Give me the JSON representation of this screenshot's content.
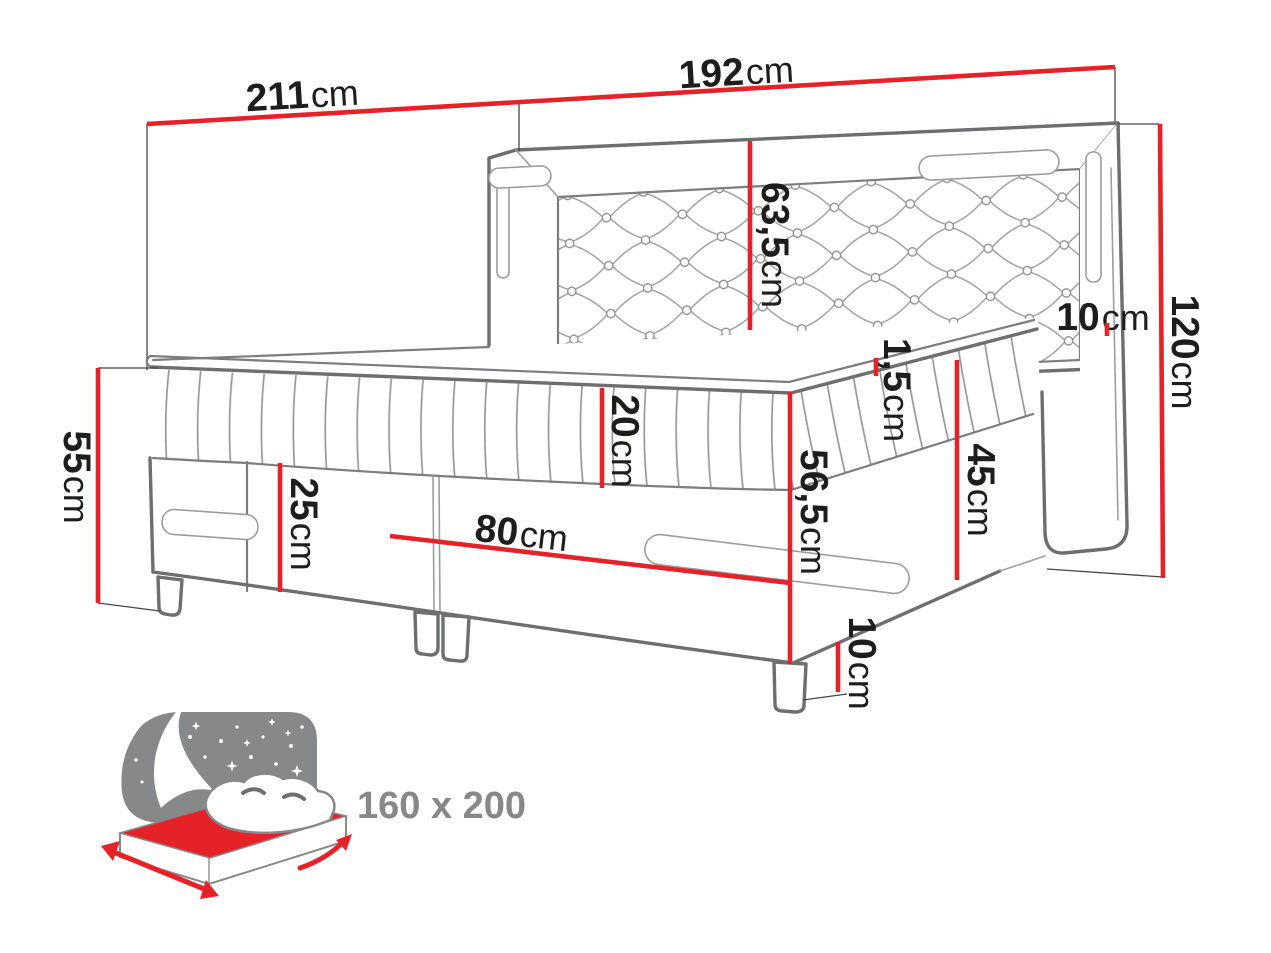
{
  "diagram_title": "boxspring bed dimension diagram",
  "dimensions": {
    "overall_width": {
      "value": "211",
      "unit": "cm"
    },
    "bed_width": {
      "value": "192",
      "unit": "cm"
    },
    "headboard_panel_height": {
      "value": "63,5",
      "unit": "cm"
    },
    "side_frame_width": {
      "value": "10",
      "unit": "cm"
    },
    "headboard_total_height": {
      "value": "120",
      "unit": "cm"
    },
    "foot_end_height": {
      "value": "55",
      "unit": "cm"
    },
    "drawer_front_height": {
      "value": "25",
      "unit": "cm"
    },
    "mattress_thickness": {
      "value": "20",
      "unit": "cm"
    },
    "topper_thickness": {
      "value": "1,5",
      "unit": "cm"
    },
    "corner_height": {
      "value": "56,5",
      "unit": "cm"
    },
    "base_side_height": {
      "value": "45",
      "unit": "cm"
    },
    "half_front_width": {
      "value": "80",
      "unit": "cm"
    },
    "leg_height": {
      "value": "10",
      "unit": "cm"
    }
  },
  "size_badge": {
    "label": "160 x 200"
  },
  "colors": {
    "dimension_red": "#e52228",
    "line_gray": "#6d6e70",
    "thin_line_gray": "#9b9da0",
    "label_black": "#1d1d1b",
    "icon_gray": "#87888a",
    "background": "#ffffff"
  }
}
